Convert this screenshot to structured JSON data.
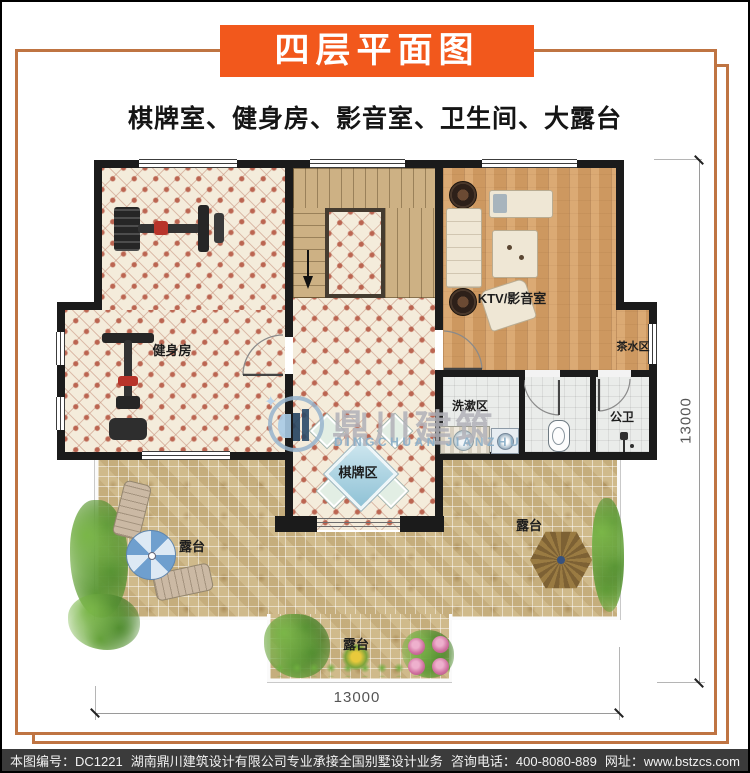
{
  "header": {
    "title": "四层平面图",
    "subtitle": "棋牌室、健身房、影音室、卫生间、大露台"
  },
  "plan": {
    "rooms": {
      "gym": "健身房",
      "ktv": "KTV/影音室",
      "tea": "茶水区",
      "wash": "洗漱区",
      "public_wc": "公卫",
      "chess": "棋牌区",
      "terrace_left": "露台",
      "terrace_right": "露台",
      "terrace_bottom": "露台"
    },
    "dimensions": {
      "right": "13000",
      "bottom": "13000"
    },
    "icons": {
      "stair_down_arrow": "stair-down-arrow",
      "umbrella": "patio-umbrella",
      "gazebo": "gazebo-roof",
      "loungers": "sun-loungers",
      "gym_equipment": "gym-equipment",
      "sofa": "sofa",
      "speakers": "floor-speakers",
      "sink": "sink",
      "toilet": "toilet",
      "shower": "shower",
      "washer": "washing-machine",
      "chess_table": "card-table",
      "plants": "shrubs-flowers"
    }
  },
  "watermark": {
    "name": "鼎川建筑",
    "latin": "DINGCHUAN JIANZHU"
  },
  "footer": {
    "plan_no": "本图编号：DC1221",
    "company": "湖南鼎川建筑设计有限公司专业承接全国别墅设计业务",
    "phone": "咨询电话：400-8080-889",
    "website": "网址：www.bstzcs.com"
  },
  "colors": {
    "banner": "#f2581c",
    "frame": "#bf7442",
    "wall": "#1b1b1b",
    "wood_floor": "#d7a167",
    "tile_floor": "#f4ecdb",
    "stair": "#cdb184",
    "mosaic": "#ccb687",
    "bath_floor": "#eaecea",
    "footer_bg": "#3b3b3b"
  }
}
